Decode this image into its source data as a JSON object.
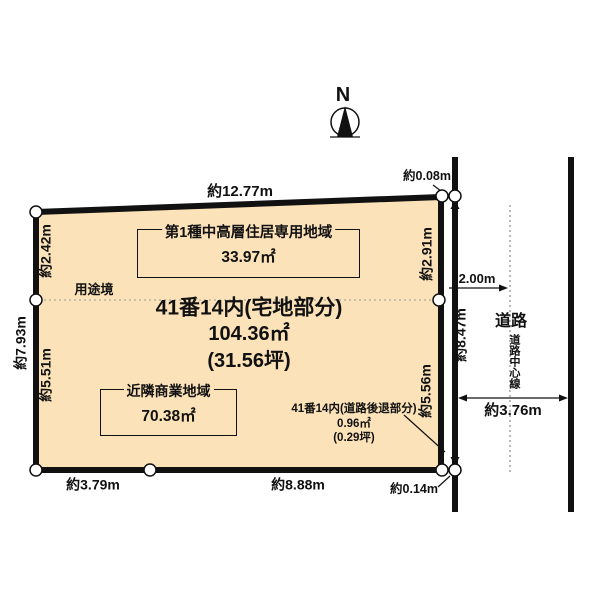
{
  "compass": {
    "north_label": "N"
  },
  "parcel": {
    "title": "41番14内(宅地部分)",
    "area_m2": "104.36㎡",
    "area_tsubo": "(31.56坪)"
  },
  "zones": {
    "residential": {
      "name": "第1種中高層住居専用地域",
      "area": "33.97㎡"
    },
    "commercial": {
      "name": "近隣商業地域",
      "area": "70.38㎡"
    }
  },
  "setback": {
    "title": "41番14内(道路後退部分)",
    "area_m2": "0.96㎡",
    "area_tsubo": "(0.29坪)"
  },
  "boundary": {
    "use_boundary_label": "用途境"
  },
  "road": {
    "label": "道路",
    "centerline_label": "道路中心線",
    "half_width": "2.00m",
    "width": "約3.76m"
  },
  "dimensions": {
    "top": "約12.77m",
    "top_right_gap": "約0.08m",
    "left_total": "約7.93m",
    "left_upper": "約2.42m",
    "left_lower": "約5.51m",
    "right_upper": "約2.91m",
    "right_lower": "約5.56m",
    "road_side": "約8.47m",
    "bottom_left": "約3.79m",
    "bottom_right": "約8.88m",
    "bottom_right_gap": "約0.14m"
  },
  "colors": {
    "plot_fill": "#fbe2b9",
    "line": "#111111",
    "marker_fill": "#ffffff"
  }
}
